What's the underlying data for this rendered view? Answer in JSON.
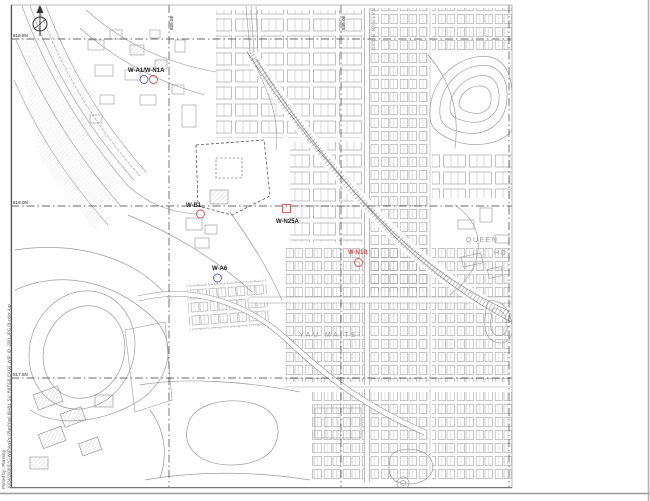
{
  "colors": {
    "marker_red": "#d05050",
    "marker_blue": "#4f5fc8",
    "map_line": "#9b9b9b",
    "grid_line": "#3a3a3a",
    "label_gray": "#9a9a9a"
  },
  "icons": {
    "north_arrow": "north-arrow-compass"
  },
  "grid": {
    "northing_labels": [
      "818.5N",
      "818.0N",
      "817.5N"
    ],
    "easting_labels": [
      "835.5E",
      "836.0E"
    ]
  },
  "markers": [
    {
      "label": "W-A1/W-N1A",
      "symbols": [
        "blue-circle",
        "red-circle"
      ]
    },
    {
      "label": "W-B1",
      "symbols": [
        "red-circle"
      ]
    },
    {
      "label": "W-N25A",
      "symbols": [
        "red-square"
      ]
    },
    {
      "label": "W-N1B",
      "symbols": [
        "red-circle"
      ]
    },
    {
      "label": "W-A6",
      "symbols": [
        "blue-circle"
      ]
    }
  ],
  "place_labels": {
    "district": "YAU MA TEI",
    "hospital_line1": "QUEEN",
    "hospital_line2": "HO",
    "road_vertical": "NATHAN ROAD"
  },
  "footer": {
    "printed_by_line": "Printed by :  Planning",
    "file_line": "10/24/2008   E:\\C-WIP\\ArcPc (Plan\\Yau) 80481_SU_R97\\GE-E-000_WIP_ID_2001.JPG (B-color 4.jp"
  }
}
